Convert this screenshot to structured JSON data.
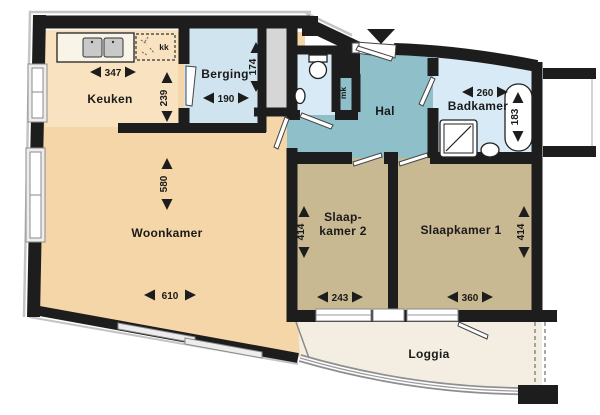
{
  "rooms": {
    "keuken": {
      "name": "Keuken",
      "width": "347",
      "depth": "239"
    },
    "berging": {
      "name": "Berging",
      "width": "190",
      "depth": "174"
    },
    "hal": {
      "name": "Hal"
    },
    "badkamer": {
      "name": "Badkamer",
      "width": "260",
      "bath_length": "183"
    },
    "woonkamer": {
      "name": "Woonkamer",
      "width": "610",
      "depth": "580"
    },
    "slaapkamer2": {
      "name_line1": "Slaap-",
      "name_line2": "kamer 2",
      "width": "243",
      "depth": "414"
    },
    "slaapkamer1": {
      "name": "Slaapkamer 1",
      "width": "360",
      "depth": "414"
    },
    "loggia": {
      "name": "Loggia"
    },
    "meterkast": {
      "abbr": "mk"
    },
    "koelkast": {
      "abbr": "kk"
    }
  },
  "colors": {
    "wall": "#1d1d1d",
    "woonkamer": "#f5d6a8",
    "keuken": "#f9e2c0",
    "bedroom": "#c9b992",
    "hal": "#8fc0ca",
    "wet_room": "#d8eaf5",
    "berging": "#cfe4ef",
    "loggia": "#f3eee1",
    "shaft": "#d6d6d6",
    "outline": "#c4c4c4"
  }
}
